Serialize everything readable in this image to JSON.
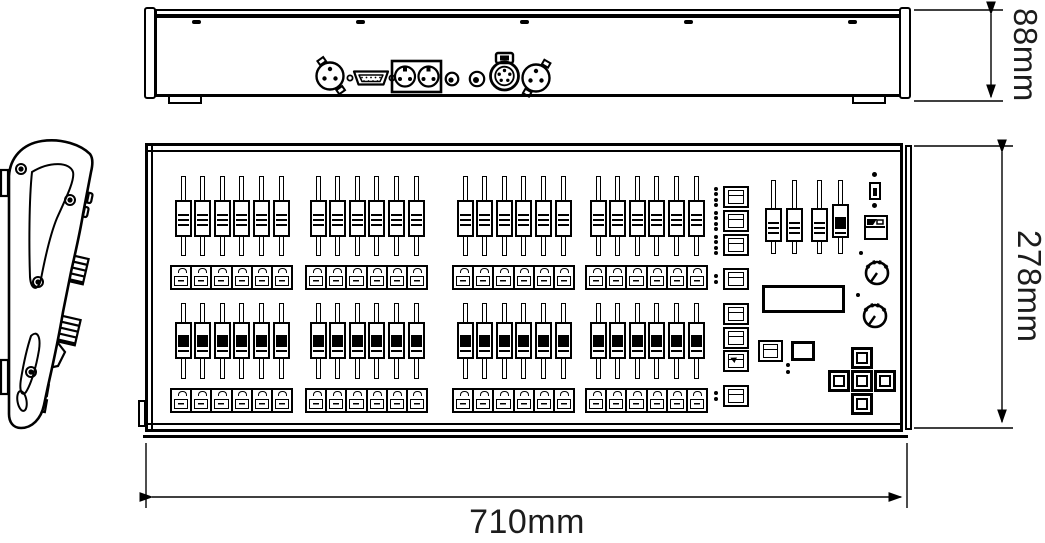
{
  "title": "DMX lighting console dimensional drawing",
  "dimensions": {
    "rear_height": "88mm",
    "panel_depth": "278mm",
    "panel_width": "710mm"
  },
  "views": {
    "rear": {
      "screws": 5,
      "feet": 2,
      "connectors": [
        "xlr-3pin",
        "db9-serial",
        "din-pair",
        "small-jack",
        "small-jack",
        "xlr-5pin-locking",
        "xlr-3pin"
      ]
    },
    "side": {
      "screws": 4
    },
    "top": {
      "fader_rows": [
        {
          "groups": 4,
          "faders_per_group": 6,
          "buttons_per_group": 6
        },
        {
          "groups": 4,
          "faders_per_group": 6,
          "buttons_per_group": 6
        }
      ],
      "scene_keys": [
        {
          "leds": 4
        },
        {
          "leds": 4
        },
        {
          "leds": 4
        },
        {
          "leds": 2
        },
        {
          "leds": 0
        },
        {
          "leds": 0
        },
        {
          "leds": 0,
          "icon": "arrow"
        },
        {
          "leds": 2
        }
      ],
      "master_faders": 4,
      "dpad_keys": 5,
      "knobs": 2
    }
  },
  "colors": {
    "line": "#000000",
    "background": "#ffffff",
    "label": "#1c1c1c"
  }
}
